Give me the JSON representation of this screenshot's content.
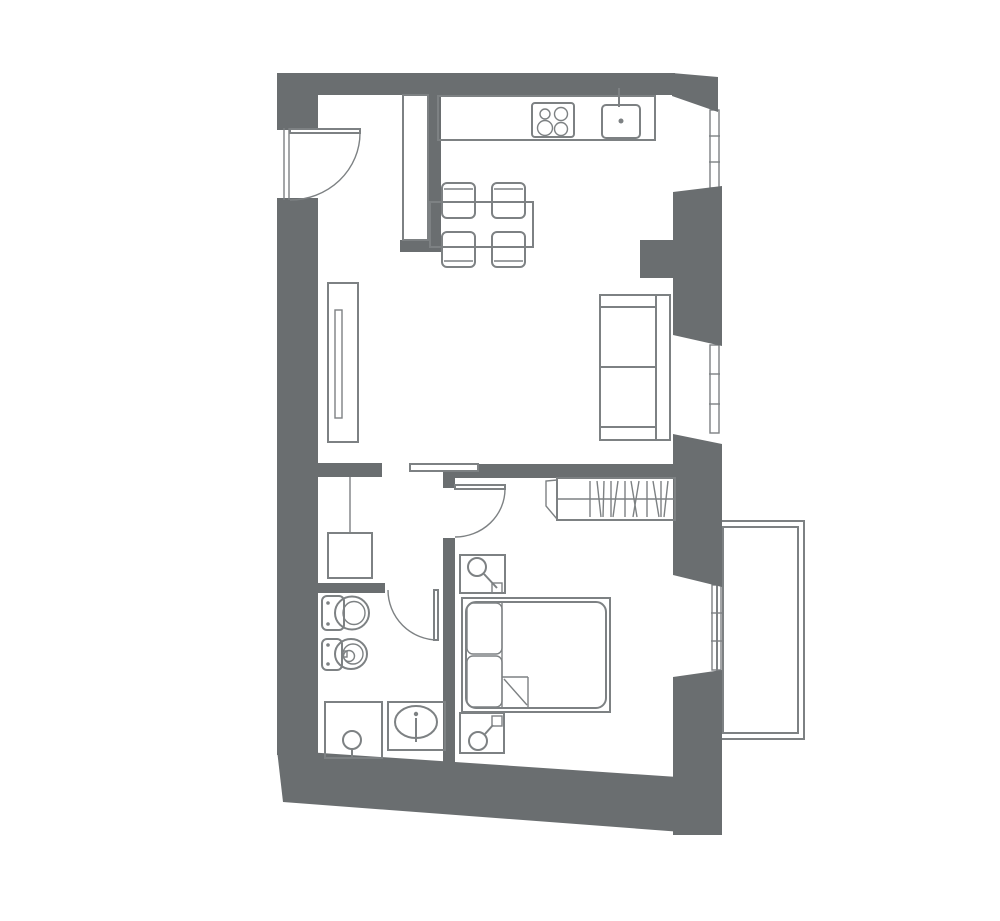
{
  "meta": {
    "type": "architectural-floor-plan",
    "canvas_width_px": 1000,
    "canvas_height_px": 921,
    "visible_text": "none"
  },
  "colors": {
    "background": "#ffffff",
    "wall": "#6a6e70",
    "line": "#7d8183"
  },
  "rooms": [
    {
      "id": "kitchen-living-room",
      "position": "top"
    },
    {
      "id": "hallway",
      "position": "middle-left"
    },
    {
      "id": "bathroom",
      "position": "bottom-left"
    },
    {
      "id": "bedroom",
      "position": "bottom-right"
    },
    {
      "id": "balcony",
      "position": "right-outside"
    }
  ],
  "fixtures_and_furniture": [
    "entry-door",
    "tall-kitchen-cabinet",
    "kitchen-counter",
    "stove-4-burners",
    "kitchen-sink",
    "dining-table",
    "chair-x4",
    "wall-cabinet-left",
    "sofa-two-seat",
    "sliding-door",
    "bedroom-door",
    "bathroom-door",
    "wardrobe-with-hangers",
    "double-bed-with-pillows",
    "nightstand-with-lamp-x2",
    "toilet",
    "bidet",
    "shower",
    "bathroom-sink",
    "hall-cabinet-washing-machine",
    "window-x3",
    "balcony-deck"
  ]
}
